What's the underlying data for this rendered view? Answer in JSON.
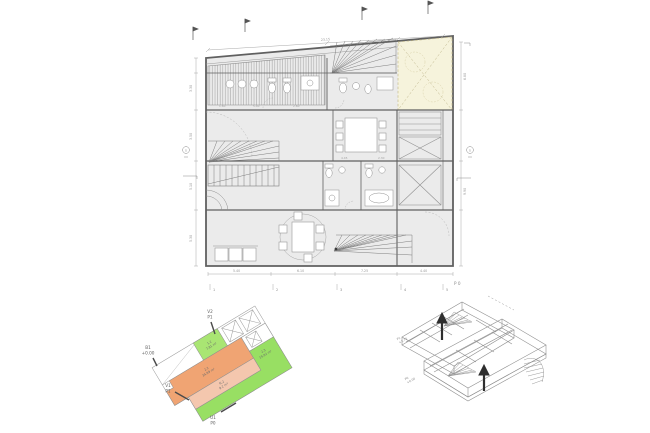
{
  "colors": {
    "cream_fill": "#f6f3dc",
    "cream_line": "#c6bd8f",
    "orange": "#f0a473",
    "pink": "#f4c7ae",
    "green": "#98df63",
    "green_light": "#a9e573",
    "floor_fill": "#ebebeb",
    "wall": "#606060",
    "thin_line": "#9a9a9a"
  },
  "main_plan": {
    "level_label": "P 0",
    "markers": {
      "section_left": "S",
      "section_right": "S"
    },
    "dims": {
      "top": "23.15",
      "left": [
        "3.30",
        "3.50",
        "5.10",
        "5.30"
      ],
      "right": [
        "6.80",
        "9.90"
      ],
      "bottom": [
        "5.40",
        "6.10",
        "7.25",
        "4.40"
      ],
      "inner": [
        "1.60",
        "5.40",
        "2.60",
        "4.45",
        "2.30"
      ],
      "axis_ticks": [
        "1",
        "2",
        "3",
        "4",
        "5"
      ]
    }
  },
  "key_plan": {
    "rooms": [
      {
        "code": "1.2",
        "area": "7.81 m²"
      },
      {
        "code": "2.2",
        "area": "34.99 m²"
      },
      {
        "code": "N.2",
        "area": "9.2 m²"
      },
      {
        "code": "2.3",
        "area": "19.92 m²"
      }
    ],
    "callouts": [
      {
        "ref": "V2",
        "level": "P1"
      },
      {
        "ref": "B1",
        "level": "+0.00"
      },
      {
        "ref": "V1",
        "level": "P1"
      },
      {
        "ref": "U1",
        "level": "P0"
      }
    ]
  },
  "axon": {
    "labels": [
      {
        "ref": "P1",
        "level": "+2.70"
      },
      {
        "ref": "P0",
        "level": "+0.00"
      }
    ]
  }
}
